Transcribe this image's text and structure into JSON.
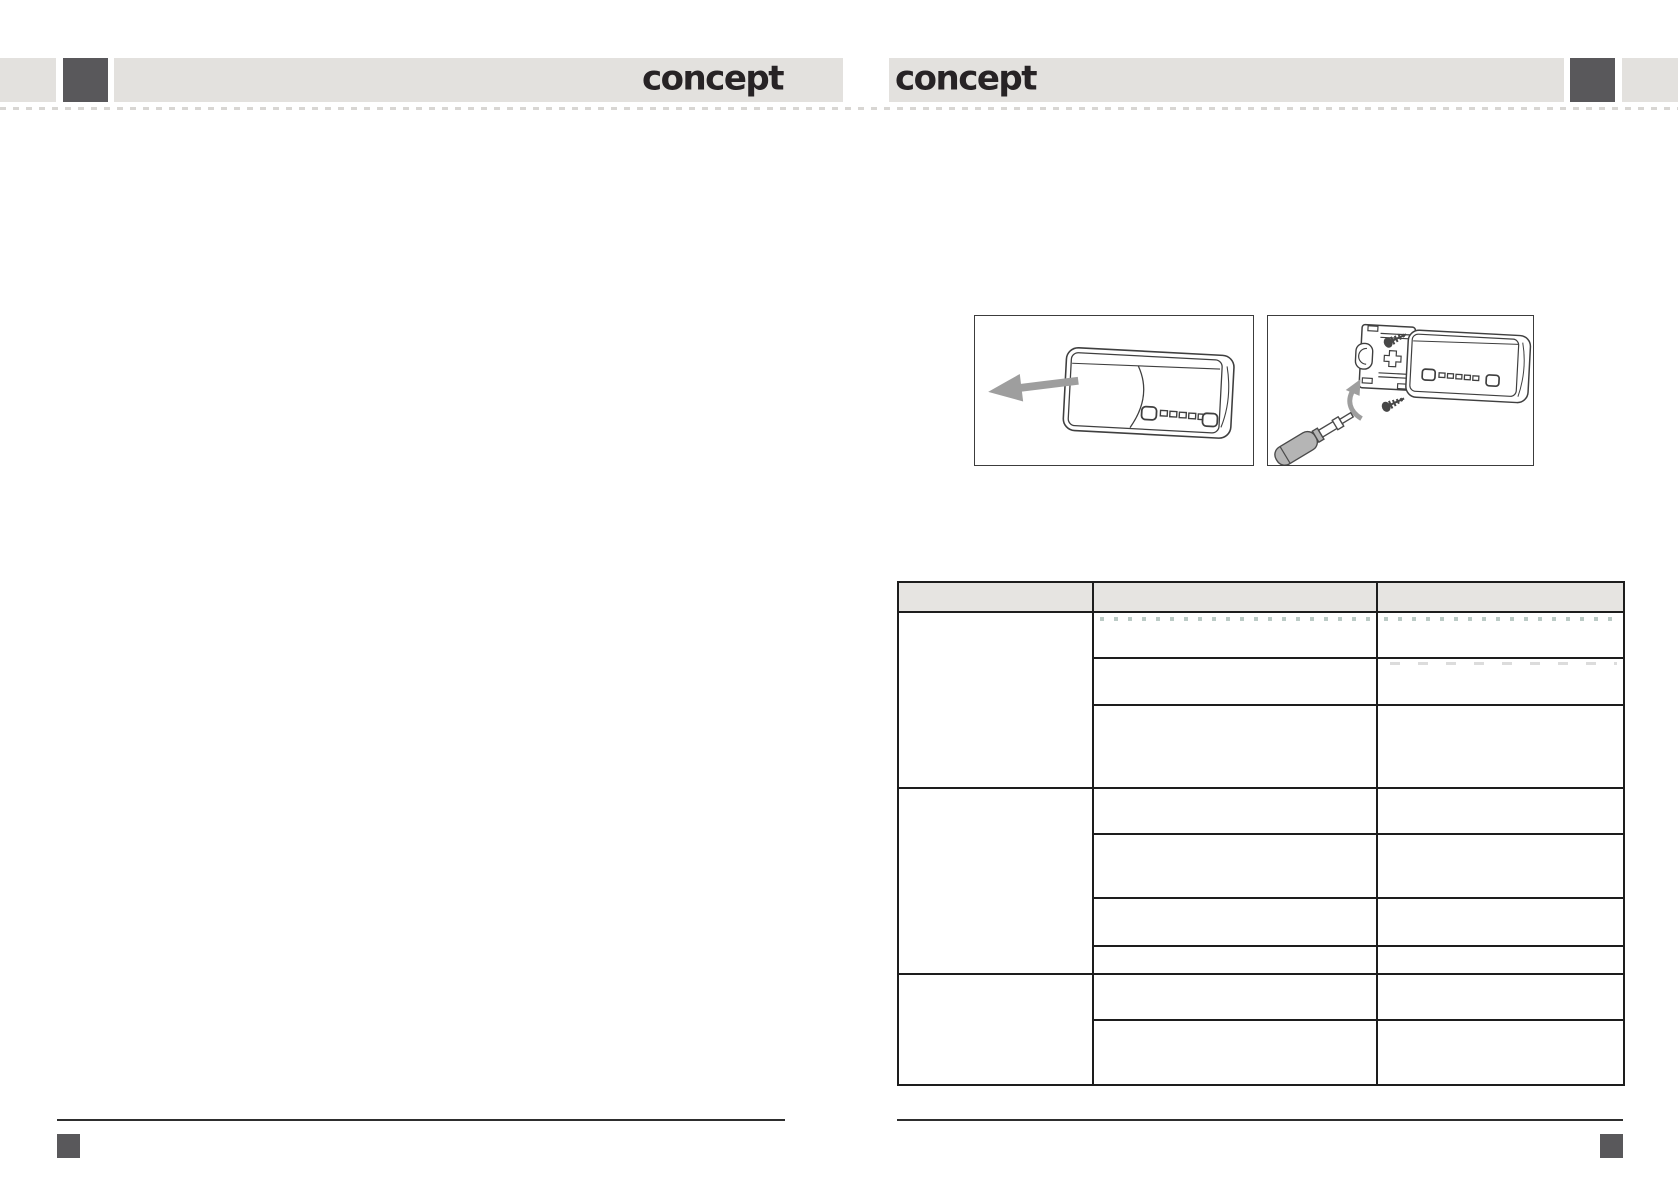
{
  "document": {
    "kind": "scanned-manual-spread",
    "pages": 2
  },
  "colors": {
    "page_bg": "#ffffff",
    "header_bar": "#e3e1de",
    "accent_square": "#59585b",
    "logo": "#272325",
    "table_border": "#1d1d1d",
    "table_header_bg": "#e6e4e1",
    "line_dark": "#2e2e2e",
    "art_line": "#3f3f3f",
    "art_gray": "#9e9e9e"
  },
  "header": {
    "left_logo": "concept",
    "right_logo": "concept"
  },
  "figures": {
    "figure1": {
      "icons": [
        "car-stereo-icon",
        "left-arrow-icon"
      ]
    },
    "figure2": {
      "icons": [
        "mounting-sleeve-icon",
        "car-stereo-icon",
        "screw-icon",
        "curved-arrow-icon",
        "screwdriver-icon"
      ]
    }
  },
  "table": {
    "columns": [
      "",
      "",
      ""
    ],
    "column_widths_px": [
      195,
      284,
      247
    ],
    "groups": [
      {
        "label": "",
        "row_heights": [
          46,
          47,
          83
        ],
        "rows": [
          [
            "",
            ""
          ],
          [
            "",
            ""
          ],
          [
            "",
            ""
          ]
        ]
      },
      {
        "label": "",
        "row_heights": [
          46,
          64,
          48,
          28
        ],
        "rows": [
          [
            "",
            ""
          ],
          [
            "",
            ""
          ],
          [
            "",
            ""
          ],
          [
            "",
            ""
          ]
        ]
      },
      {
        "label": "",
        "row_heights": [
          46,
          65
        ],
        "rows": [
          [
            "",
            ""
          ],
          [
            "",
            ""
          ]
        ]
      }
    ]
  }
}
